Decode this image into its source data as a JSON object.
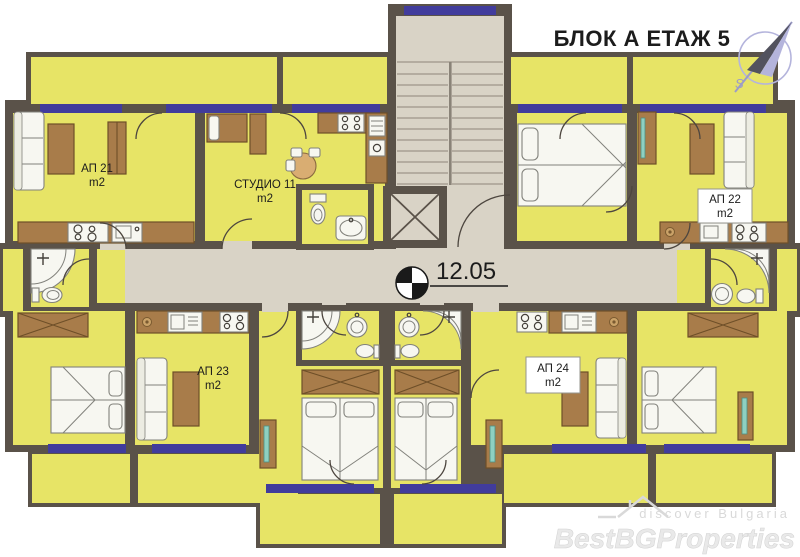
{
  "title": "БЛОК А ЕТАЖ 5",
  "elevation": "12.05",
  "compass": {
    "south": "S"
  },
  "units": {
    "ap21": {
      "label": "АП 21",
      "area": "m2"
    },
    "studio11": {
      "label": "СТУДИО 11",
      "area": "m2"
    },
    "ap22": {
      "label": "АП 22",
      "area": "m2"
    },
    "ap23": {
      "label": "АП 23",
      "area": "m2"
    },
    "ap24": {
      "label": "АП 24",
      "area": "m2"
    }
  },
  "watermark": {
    "tagline": "discover Bulgaria",
    "brand": "BestBGProperties"
  },
  "colors": {
    "wall": "#5a5249",
    "room_yellow": "#e7e466",
    "corridor_beige": "#d9d3c6",
    "window_blue": "#413c9c",
    "furniture_brown": "#a87c4a",
    "accent_teal": "#8ed0c1"
  }
}
